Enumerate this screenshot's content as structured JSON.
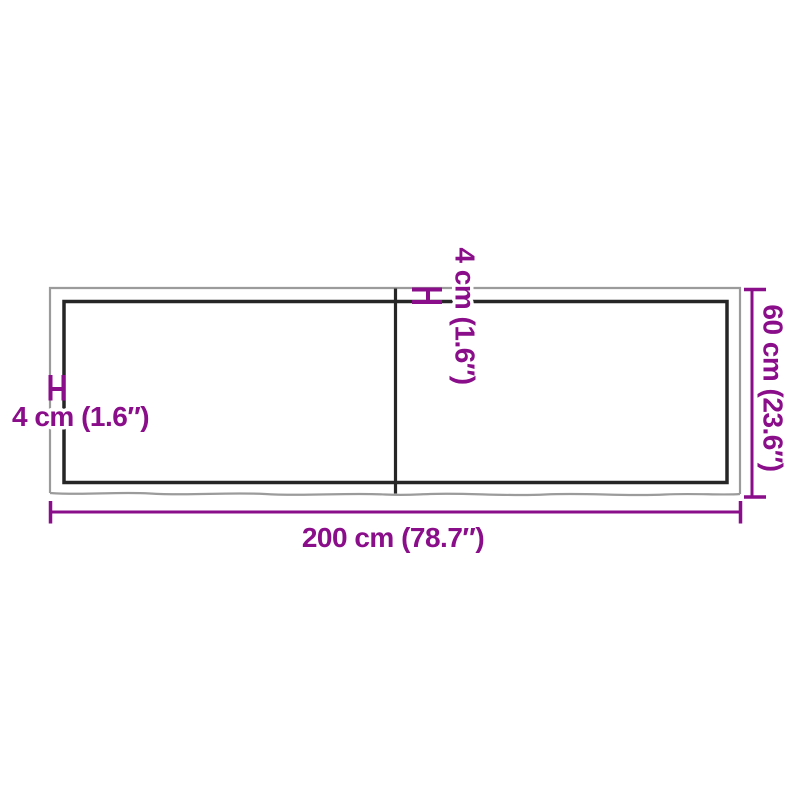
{
  "diagram": {
    "dimensions": {
      "width_label": "200 cm (78.7″)",
      "height_label": "60 cm (23.6″)",
      "thickness_left_label": "4 cm (1.6″)",
      "thickness_top_label": "4 cm (1.6″)"
    },
    "colors": {
      "dimension_accent": "#8a0d8a",
      "outer_edge": "#9b9b9b",
      "inner_edge": "#262626",
      "background": "#ffffff"
    }
  }
}
